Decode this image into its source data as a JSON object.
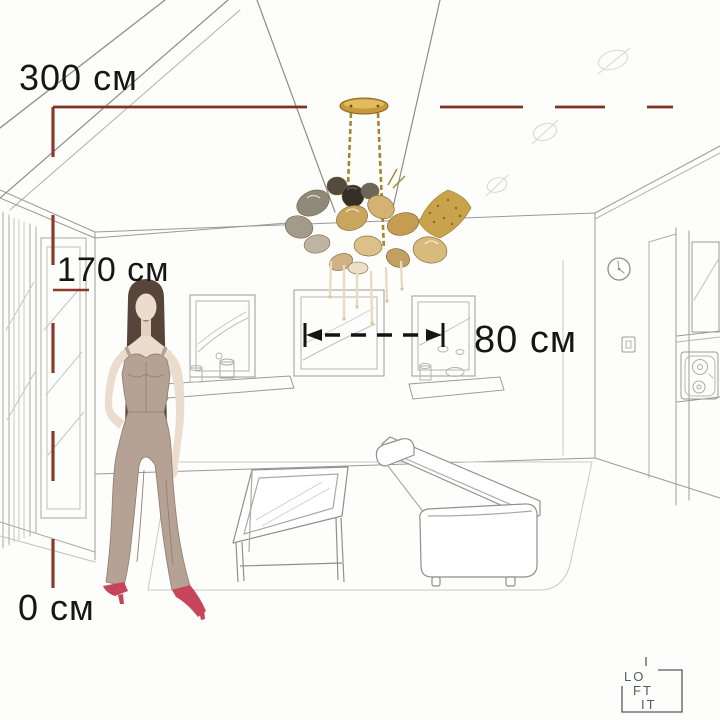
{
  "title": "Chandelier room scale illustration",
  "dimensions": {
    "ceiling_height_label": "300 см",
    "person_height_label": "170 см",
    "floor_level_label": "0 см",
    "fixture_width_label": "80 см",
    "ceiling_height_cm": 300,
    "person_height_cm": 170,
    "floor_level_cm": 0,
    "fixture_width_cm": 80
  },
  "colors": {
    "dimension_line": "#8b3a2a",
    "arrow": "#141414",
    "sketch_line": "#9a9a98",
    "gold": "#b98a2e",
    "amber_glass": "#cda968",
    "smoke_glass": "#958c7e",
    "mesh_gold": "#c9a34b",
    "rod_cream": "#e8dcc0",
    "hair": "#57453a",
    "skin": "#ecdccd",
    "outfit": "#b5a294",
    "shoes": "#c7455b",
    "logo": "#565b60"
  },
  "scene": {
    "fixture": "gold glass-petal chandelier on two chains",
    "person": "woman fashion sketch for scale",
    "wall_items": [
      "wall-clock",
      "light-switch",
      "picture-frames",
      "floating-shelves",
      "speaker-cabinet"
    ],
    "furniture": [
      "glass-coffee-table",
      "sofa",
      "rug"
    ]
  },
  "logo": {
    "line1": "LO",
    "line2": "FT",
    "line3": "IT"
  }
}
